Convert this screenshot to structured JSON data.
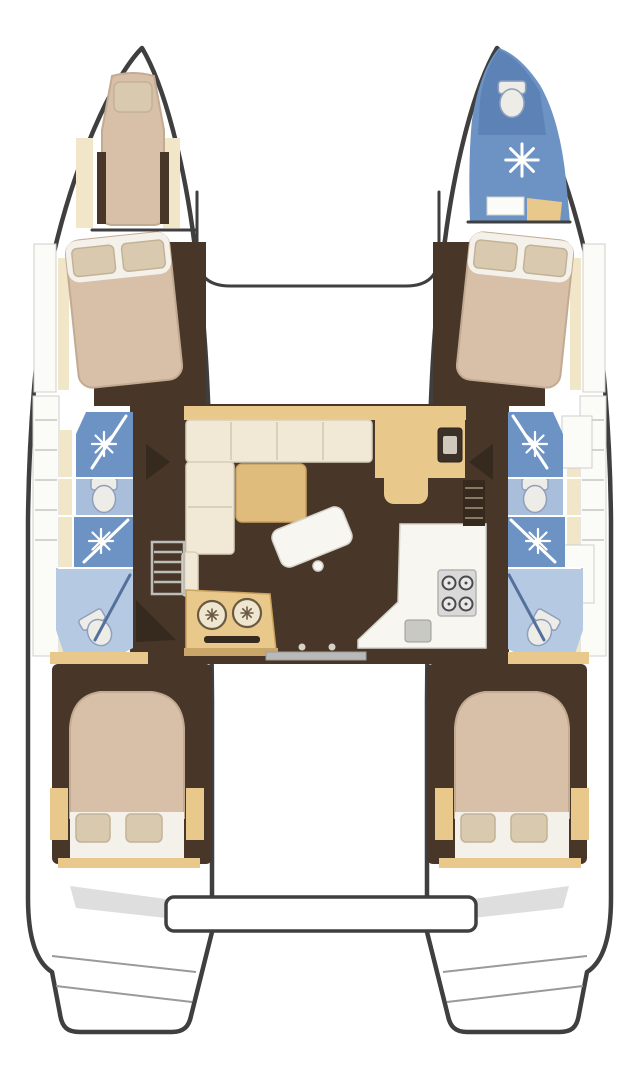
{
  "diagram": {
    "type": "boat-floor-plan",
    "subject": "catamaran-interior-layout",
    "view": "top-down"
  },
  "palette": {
    "outline": "#3f3f3f",
    "floor_brown": "#483628",
    "floor_brown_dark": "#362a1f",
    "wood_tan": "#e9c88c",
    "wood_edge": "#c9a25e",
    "wood_tan_pale": "#f2e6c9",
    "mattress_tan": "#d7bfa8",
    "mattress_edge": "#c3ab92",
    "pillow_tan": "#d9c9af",
    "pillow_edge": "#c2b296",
    "sheet_white": "#f4f1ea",
    "cushion_cream": "#f1e9d5",
    "cushion_edge": "#d9d0ba",
    "table_tan": "#e0bc7c",
    "counter_white": "#f7f6f1",
    "counter_edge": "#d6d3ca",
    "shower_blue": "#6d93c5",
    "shower_blue_dark": "#5c82b6",
    "wc_zone_blue": "#a9bedb",
    "bath_blue_light": "#b6c9e2",
    "fixture_white": "#edece6",
    "fixture_edge": "#8fa0bd",
    "stove_gray": "#d9d9d9",
    "burner_dark": "#4a4a4a",
    "step_gray": "#b9b9b9"
  },
  "features": {
    "port_hull": [
      "bow-berth",
      "forward-double-cabin",
      "forward-shower",
      "wc",
      "aft-shower",
      "aft-bathroom",
      "aft-double-cabin"
    ],
    "starboard_hull": [
      "bow-bathroom-with-shower",
      "forward-double-cabin",
      "forward-shower",
      "wc",
      "aft-shower",
      "aft-bathroom",
      "aft-double-cabin"
    ],
    "saloon": [
      "l-shaped-sofa",
      "saloon-table",
      "coffee-table",
      "sideboard-with-appliance",
      "galley-counter",
      "stove-4-burner",
      "double-round-sinks",
      "companionway-steps-port",
      "companionway-steps-starboard",
      "aft-sliding-door"
    ],
    "stern": [
      "aft-crossbeam-platform",
      "transom-steps-port",
      "transom-steps-starboard"
    ]
  },
  "counts": {
    "double_beds": 4,
    "bow_berths": 1,
    "showers": 5,
    "toilets": 5,
    "stove_burners": 4,
    "galley_sinks": 2
  }
}
